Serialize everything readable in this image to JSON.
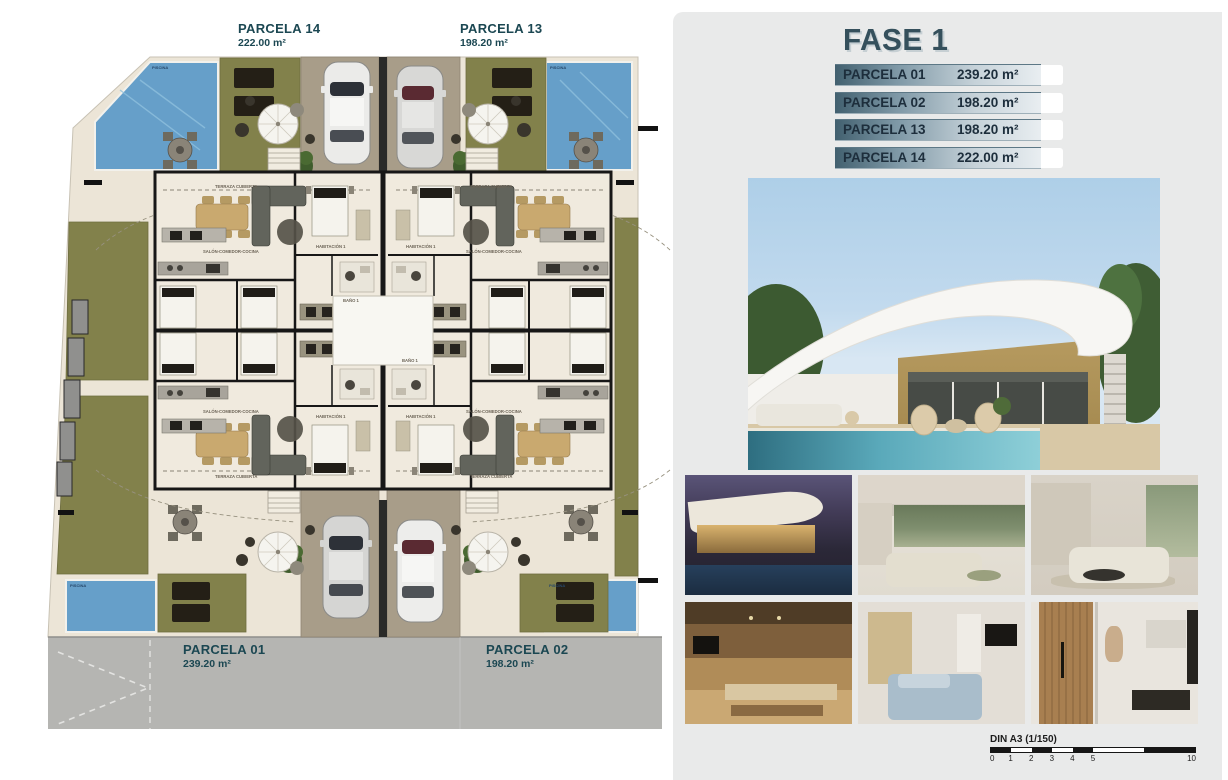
{
  "plan": {
    "parcel_labels": {
      "p14": {
        "name": "PARCELA 14",
        "area": "222.00 m²"
      },
      "p13": {
        "name": "PARCELA 13",
        "area": "198.20 m²"
      },
      "p01": {
        "name": "PARCELA 01",
        "area": "239.20 m²"
      },
      "p02": {
        "name": "PARCELA 02",
        "area": "198.20 m²"
      }
    },
    "room_labels": {
      "living": "SALÓN-COMEDOR-COCINA",
      "terrace": "TERRAZA CUBIERTA",
      "bedroom": "HABITACIÓN 1",
      "bath": "BAÑO 1",
      "pool": "PISCINA"
    },
    "colors": {
      "pool": "#669fc9",
      "grass": "#82814b",
      "terrace": "#ece5d7",
      "driveway": "#a89d89",
      "road": "#b5b5b2",
      "wall": "#171717"
    }
  },
  "panel": {
    "title": "FASE 1",
    "accent_color": "#35505c",
    "table": {
      "rows": [
        {
          "label": "PARCELA 01",
          "area": "239.20 m²"
        },
        {
          "label": "PARCELA 02",
          "area": "198.20 m²"
        },
        {
          "label": "PARCELA 13",
          "area": "198.20 m²"
        },
        {
          "label": "PARCELA 14",
          "area": "222.00 m²"
        }
      ]
    },
    "scale_bar": {
      "label": "DIN A3 (1/150)",
      "ticks": [
        "0",
        "1",
        "2",
        "3",
        "4",
        "5",
        "10"
      ]
    }
  }
}
